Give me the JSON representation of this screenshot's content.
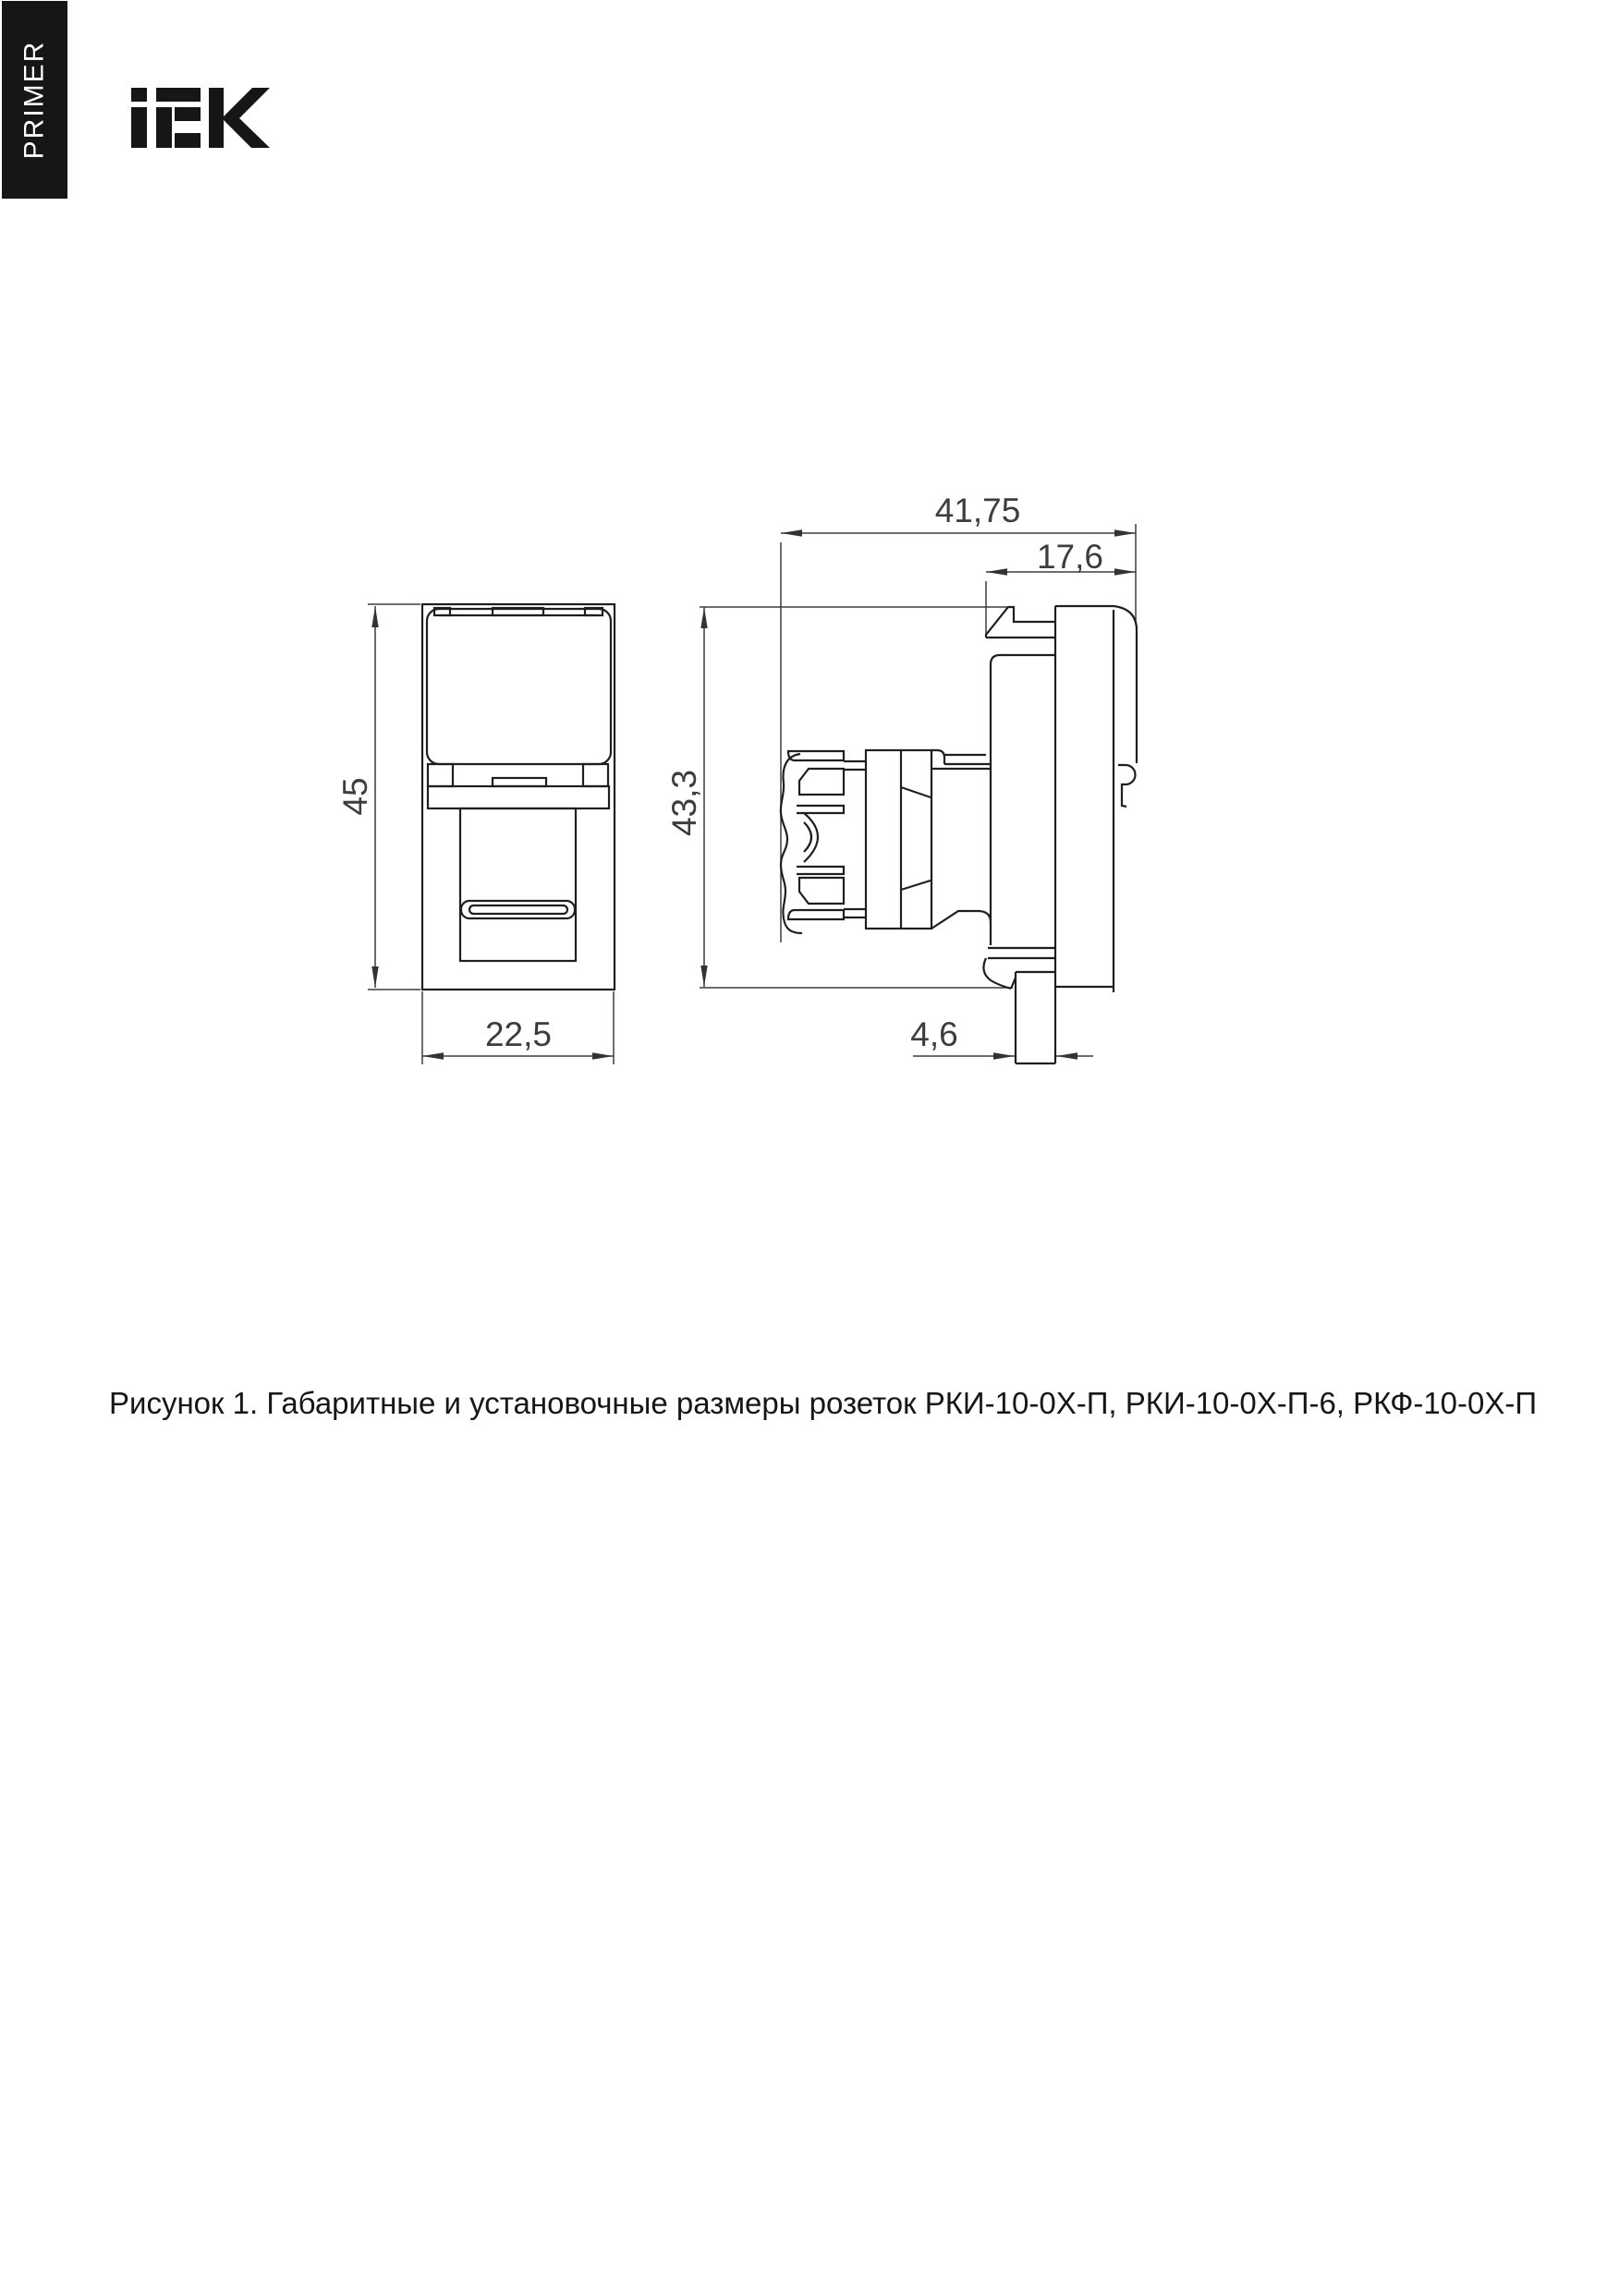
{
  "sidebar_tab": {
    "label": "PRIMER"
  },
  "brand": {
    "name": "IEK"
  },
  "figure": {
    "caption": "Рисунок 1. Габаритные и установочные размеры розеток РКИ-10-0Х-П, РКИ-10-0Х-П-6, РКФ-10-0Х-П",
    "front_view": {
      "width_mm": "22,5",
      "height_mm": "45"
    },
    "side_view": {
      "overall_depth_mm": "41,75",
      "front_depth_mm": "17,6",
      "height_mm": "43,3",
      "lug_width_mm": "4,6"
    }
  },
  "colors": {
    "line": "#1f1f1f",
    "dim_line": "#3d3d3d",
    "tab_bg": "#161616",
    "tab_text": "#ffffff",
    "page_bg": "#ffffff",
    "text": "#161616"
  }
}
